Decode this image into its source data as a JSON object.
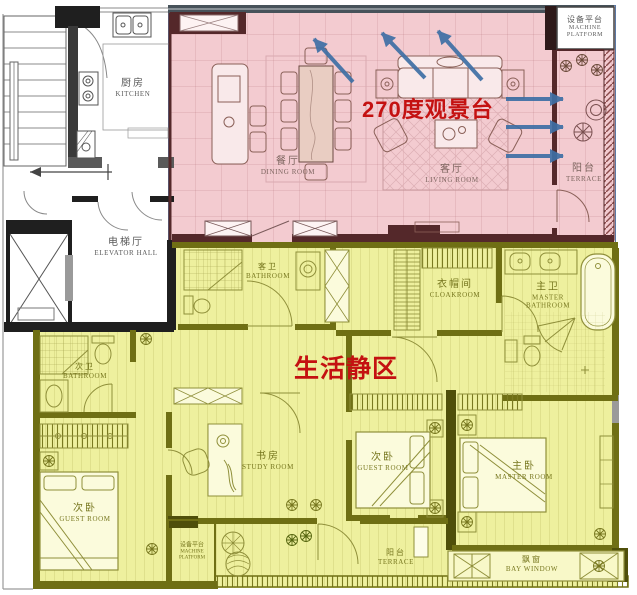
{
  "annotations": {
    "view_platform": {
      "text": "270度观景台"
    },
    "quiet_zone": {
      "text": "生活静区"
    }
  },
  "rooms": {
    "kitchen": {
      "zh": "厨房",
      "en": "KITCHEN"
    },
    "elevator_hall": {
      "zh": "电梯厅",
      "en": "ELEVATOR HALL"
    },
    "dining_room": {
      "zh": "餐厅",
      "en": "DINING ROOM"
    },
    "living_room": {
      "zh": "客厅",
      "en": "LIVING ROOM"
    },
    "machine_platform_top": {
      "zh": "设备平台",
      "en": "MACHINE PLATFORM"
    },
    "terrace_right": {
      "zh": "阳台",
      "en": "TERRACE"
    },
    "hall_bathroom": {
      "zh": "客卫",
      "en": "BATHROOM"
    },
    "cloakroom": {
      "zh": "衣帽间",
      "en": "CLOAKROOM"
    },
    "master_bathroom": {
      "zh": "主卫",
      "en": "MASTER BATHROOM"
    },
    "second_bathroom": {
      "zh": "次卫",
      "en": "BATHROOM"
    },
    "guest_room_left": {
      "zh": "次卧",
      "en": "GUEST ROOM"
    },
    "study_room": {
      "zh": "书房",
      "en": "STUDY ROOM"
    },
    "guest_room_mid": {
      "zh": "次卧",
      "en": "GUEST ROOM"
    },
    "master_room": {
      "zh": "主卧",
      "en": "MASTER ROOM"
    },
    "machine_platform_bottom": {
      "zh": "设备平台",
      "en": "MACHINE PLATFORM"
    },
    "terrace_bottom": {
      "zh": "阳台",
      "en": "TERRACE"
    },
    "bay_window": {
      "zh": "飘窗",
      "en": "BAY WINDOW"
    }
  },
  "colors": {
    "view_zone_fill": "#f3cbd0",
    "quiet_zone_fill": "#eef09e",
    "view_zone_wall": "#54282a",
    "quiet_zone_wall": "#6f6f14",
    "arrow_blue": "#3e6fa5",
    "annotation_red": "#c41111"
  }
}
